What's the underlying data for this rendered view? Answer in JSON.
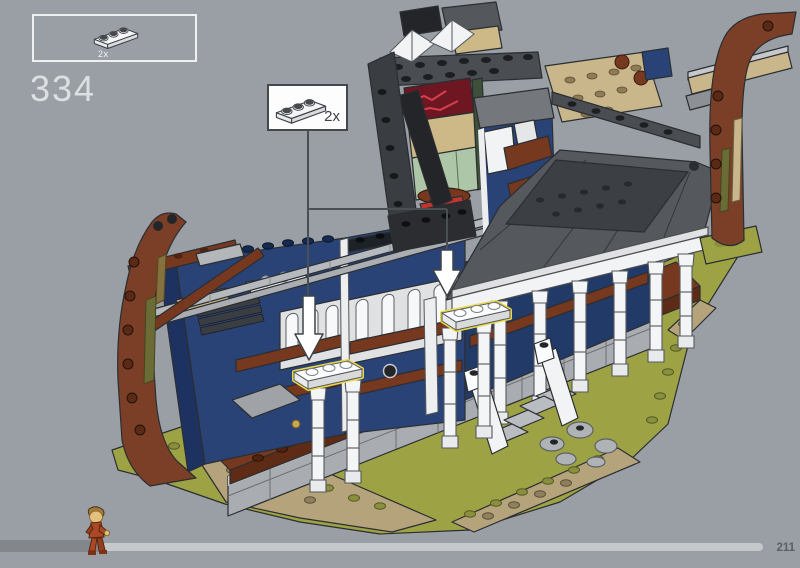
{
  "background_color": "#999fa5",
  "step_number": "334",
  "parts_box": {
    "part": "plate-1x3-white",
    "quantity": "2x"
  },
  "callout": {
    "part": "plate-1x3-white",
    "quantity": "2x",
    "placement_arrows": 2,
    "highlight_color": "#ecd94a"
  },
  "model": {
    "label": "isometric-lego-building-under-construction",
    "highlighted_plate_count": 2,
    "palette": {
      "reddish_brown": "#7b3f27",
      "dark_blue": "#2a4377",
      "dark_red": "#8a4656",
      "olive_green": "#9da345",
      "dark_tan": "#b5a37b",
      "tan": "#c9b68a",
      "sand_green": "#aec6a8",
      "roof_dark_gray": "#3c4044",
      "light_gray": "#b6b9bd",
      "white": "#f2f3f4",
      "neon_sign_red": "#6e1622"
    }
  },
  "footer": {
    "page_number": "211",
    "progress_fraction": 0.13,
    "track_elapsed_color": "#83878c",
    "track_remaining_color": "#c5c9cc"
  }
}
